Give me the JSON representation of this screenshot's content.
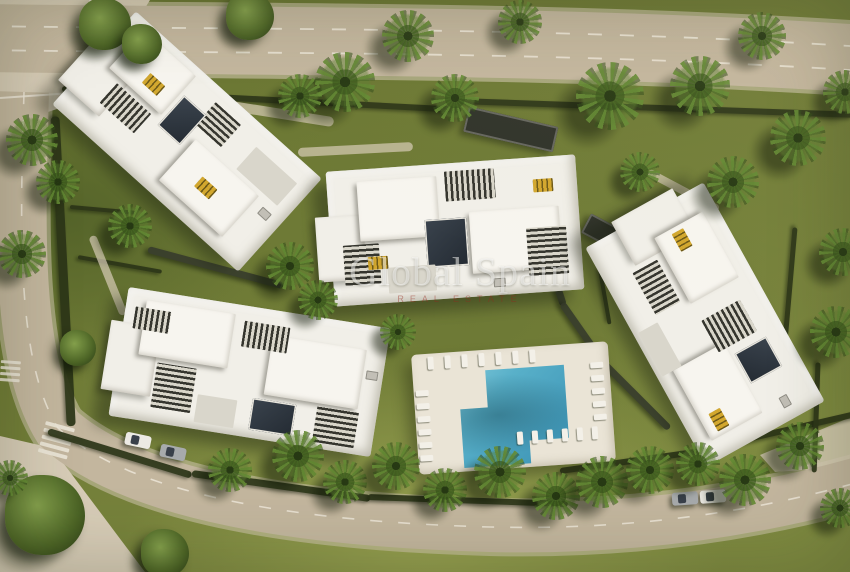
{
  "watermark": {
    "line1": "Global Spain",
    "line2": "REAL ESTATE"
  },
  "palette": {
    "building": "#f1efe8",
    "roof_shade": "#d9d6cb",
    "slat_dark": "#35352e",
    "road": "#c3b69e",
    "pavement": "#d7ccb7",
    "grass": "#6f7b36",
    "grass_light": "#8f9a4c",
    "grass_dark": "#55642a",
    "hedge": "#2c3518",
    "wall": "#383d2c",
    "pool_deck": "#eae4d6",
    "water_light": "#9fd8e4",
    "water_deep": "#2f86ac",
    "palm": "#5c8030",
    "lounger": "#d2a72e",
    "car_white": "#eceae4",
    "car_silver": "#a7aaac"
  },
  "scene": {
    "buildings": [
      {
        "id": "top-left",
        "x": 62,
        "y": 79,
        "w": 250,
        "h": 125,
        "rot": 42,
        "details": [
          {
            "t": "ext",
            "x": -12,
            "y": 28,
            "w": 55,
            "h": 75
          },
          {
            "t": "vol",
            "x": 18,
            "y": 8,
            "w": 70,
            "h": 52
          },
          {
            "t": "vol",
            "x": 130,
            "y": 55,
            "w": 85,
            "h": 55
          },
          {
            "t": "slat",
            "x": 34,
            "y": 66,
            "w": 46,
            "h": 26
          },
          {
            "t": "slatv",
            "x": 120,
            "y": 14,
            "w": 34,
            "h": 30
          },
          {
            "t": "glass",
            "x": 92,
            "y": 30,
            "w": 30,
            "h": 40
          },
          {
            "t": "terr",
            "x": 180,
            "y": 20,
            "w": 55,
            "h": 30
          },
          {
            "t": "yl",
            "x": 52,
            "y": 36,
            "w": 20,
            "h": 13
          },
          {
            "t": "yl",
            "x": 160,
            "y": 78,
            "w": 20,
            "h": 13
          },
          {
            "t": "ac",
            "x": 225,
            "y": 60,
            "w": 12,
            "h": 9
          }
        ]
      },
      {
        "id": "center",
        "x": 330,
        "y": 163,
        "w": 250,
        "h": 135,
        "rot": -4,
        "details": [
          {
            "t": "ext",
            "x": -14,
            "y": 45,
            "w": 48,
            "h": 65
          },
          {
            "t": "vol",
            "x": 30,
            "y": 12,
            "w": 80,
            "h": 60
          },
          {
            "t": "vol",
            "x": 140,
            "y": 50,
            "w": 90,
            "h": 62
          },
          {
            "t": "slatv",
            "x": 12,
            "y": 75,
            "w": 36,
            "h": 40
          },
          {
            "t": "slat",
            "x": 118,
            "y": 8,
            "w": 50,
            "h": 30
          },
          {
            "t": "glass",
            "x": 95,
            "y": 55,
            "w": 42,
            "h": 48
          },
          {
            "t": "slatv",
            "x": 196,
            "y": 70,
            "w": 40,
            "h": 48
          },
          {
            "t": "terr",
            "x": 55,
            "y": 100,
            "w": 48,
            "h": 26
          },
          {
            "t": "yl",
            "x": 36,
            "y": 88,
            "w": 20,
            "h": 13
          },
          {
            "t": "yl",
            "x": 206,
            "y": 22,
            "w": 20,
            "h": 13
          },
          {
            "t": "ac",
            "x": 160,
            "y": 118,
            "w": 12,
            "h": 9
          }
        ]
      },
      {
        "id": "right",
        "x": 580,
        "y": 257,
        "w": 250,
        "h": 135,
        "rot": 61,
        "details": [
          {
            "t": "ext",
            "x": -10,
            "y": 30,
            "w": 50,
            "h": 70
          },
          {
            "t": "vol",
            "x": 25,
            "y": 15,
            "w": 75,
            "h": 55
          },
          {
            "t": "vol",
            "x": 150,
            "y": 60,
            "w": 80,
            "h": 58
          },
          {
            "t": "slat",
            "x": 45,
            "y": 78,
            "w": 48,
            "h": 28
          },
          {
            "t": "slatv",
            "x": 120,
            "y": 25,
            "w": 36,
            "h": 44
          },
          {
            "t": "glass",
            "x": 165,
            "y": 20,
            "w": 34,
            "h": 36
          },
          {
            "t": "terr",
            "x": 100,
            "y": 108,
            "w": 50,
            "h": 22
          },
          {
            "t": "yl",
            "x": 30,
            "y": 40,
            "w": 20,
            "h": 13
          },
          {
            "t": "yl",
            "x": 205,
            "y": 95,
            "w": 20,
            "h": 13
          },
          {
            "t": "ac",
            "x": 225,
            "y": 30,
            "w": 12,
            "h": 9
          }
        ]
      },
      {
        "id": "bottom-left",
        "x": 117,
        "y": 307,
        "w": 265,
        "h": 130,
        "rot": 9,
        "details": [
          {
            "t": "ext",
            "x": -12,
            "y": 35,
            "w": 50,
            "h": 70
          },
          {
            "t": "vol",
            "x": 20,
            "y": 10,
            "w": 90,
            "h": 55
          },
          {
            "t": "vol",
            "x": 150,
            "y": 25,
            "w": 95,
            "h": 60
          },
          {
            "t": "slatv",
            "x": 40,
            "y": 70,
            "w": 40,
            "h": 45
          },
          {
            "t": "slat",
            "x": 120,
            "y": 15,
            "w": 46,
            "h": 26
          },
          {
            "t": "glass",
            "x": 140,
            "y": 90,
            "w": 44,
            "h": 32
          },
          {
            "t": "slatv",
            "x": 205,
            "y": 88,
            "w": 42,
            "h": 36
          },
          {
            "t": "terr",
            "x": 85,
            "y": 95,
            "w": 40,
            "h": 28
          },
          {
            "t": "slat",
            "x": 10,
            "y": 18,
            "w": 36,
            "h": 22
          },
          {
            "t": "ac",
            "x": 248,
            "y": 45,
            "w": 12,
            "h": 9
          }
        ]
      }
    ],
    "pool": {
      "x": 415,
      "y": 348,
      "w": 197,
      "h": 120,
      "rot": -4,
      "lounger_rows": [
        {
          "x": 16,
          "y": 3,
          "n": 7,
          "dx": 17,
          "dy": 0,
          "w": 6,
          "h": 13
        },
        {
          "x": 2,
          "y": 36,
          "n": 6,
          "dx": 0,
          "dy": 13,
          "w": 13,
          "h": 6
        },
        {
          "x": 178,
          "y": 20,
          "n": 5,
          "dx": 0,
          "dy": 13,
          "w": 13,
          "h": 6
        },
        {
          "x": 100,
          "y": 84,
          "n": 6,
          "dx": 15,
          "dy": 0,
          "w": 6,
          "h": 13
        }
      ]
    },
    "hedges": [
      {
        "x": 55,
        "y": 112,
        "len": 310,
        "w": 9,
        "rot": 87
      },
      {
        "x": 62,
        "y": 86,
        "len": 400,
        "w": 6,
        "rot": 3
      },
      {
        "x": 458,
        "y": 98,
        "len": 395,
        "w": 6,
        "rot": 2
      },
      {
        "x": 48,
        "y": 428,
        "len": 150,
        "w": 7,
        "rot": 17
      },
      {
        "x": 192,
        "y": 470,
        "len": 180,
        "w": 7,
        "rot": 8
      },
      {
        "x": 368,
        "y": 494,
        "len": 200,
        "w": 6,
        "rot": 2
      },
      {
        "x": 560,
        "y": 468,
        "len": 145,
        "w": 6,
        "rot": -8
      },
      {
        "x": 700,
        "y": 447,
        "len": 160,
        "w": 6,
        "rot": -13
      },
      {
        "x": 148,
        "y": 246,
        "len": 140,
        "w": 7,
        "rot": 15,
        "dark": true
      },
      {
        "x": 545,
        "y": 245,
        "len": 60,
        "w": 7,
        "rot": 72,
        "dark": true
      },
      {
        "x": 562,
        "y": 300,
        "len": 75,
        "w": 7,
        "rot": 55,
        "dark": true
      },
      {
        "x": 602,
        "y": 358,
        "len": 95,
        "w": 7,
        "rot": 45,
        "dark": true
      },
      {
        "x": 600,
        "y": 268,
        "len": 55,
        "w": 4,
        "rot": 80
      },
      {
        "x": 628,
        "y": 278,
        "len": 55,
        "w": 4,
        "rot": 80
      },
      {
        "x": 655,
        "y": 288,
        "len": 50,
        "w": 4,
        "rot": 80
      },
      {
        "x": 795,
        "y": 225,
        "len": 120,
        "w": 5,
        "rot": 95
      },
      {
        "x": 818,
        "y": 360,
        "len": 110,
        "w": 5,
        "rot": 92
      },
      {
        "x": 70,
        "y": 205,
        "len": 65,
        "w": 4,
        "rot": 5
      },
      {
        "x": 78,
        "y": 255,
        "len": 85,
        "w": 4,
        "rot": 10
      }
    ],
    "paths": [
      {
        "x": 225,
        "y": 100,
        "len": 110,
        "w": 10,
        "rot": 9
      },
      {
        "x": 298,
        "y": 148,
        "len": 115,
        "w": 9,
        "rot": -3
      },
      {
        "x": 92,
        "y": 232,
        "len": 85,
        "w": 8,
        "rot": 68
      },
      {
        "x": 648,
        "y": 168,
        "len": 80,
        "w": 8,
        "rot": 28
      }
    ],
    "ramps": [
      {
        "x": 466,
        "y": 106,
        "len": 92,
        "w": 26,
        "rot": 13
      },
      {
        "x": 586,
        "y": 212,
        "len": 70,
        "w": 22,
        "rot": 28
      }
    ],
    "palms": [
      [
        345,
        82,
        30
      ],
      [
        408,
        36,
        26
      ],
      [
        300,
        96,
        22
      ],
      [
        455,
        98,
        24
      ],
      [
        520,
        22,
        22
      ],
      [
        610,
        96,
        34
      ],
      [
        700,
        86,
        30
      ],
      [
        762,
        36,
        24
      ],
      [
        798,
        138,
        28
      ],
      [
        845,
        92,
        22
      ],
      [
        32,
        140,
        26
      ],
      [
        58,
        182,
        22
      ],
      [
        22,
        254,
        24
      ],
      [
        130,
        226,
        22
      ],
      [
        290,
        266,
        24
      ],
      [
        318,
        300,
        20
      ],
      [
        398,
        332,
        18
      ],
      [
        640,
        172,
        20
      ],
      [
        733,
        182,
        26
      ],
      [
        843,
        252,
        24
      ],
      [
        836,
        332,
        26
      ],
      [
        230,
        470,
        22
      ],
      [
        298,
        456,
        26
      ],
      [
        345,
        482,
        22
      ],
      [
        396,
        466,
        24
      ],
      [
        445,
        490,
        22
      ],
      [
        500,
        472,
        26
      ],
      [
        556,
        496,
        24
      ],
      [
        602,
        482,
        26
      ],
      [
        650,
        470,
        24
      ],
      [
        698,
        464,
        22
      ],
      [
        745,
        480,
        26
      ],
      [
        800,
        446,
        24
      ],
      [
        840,
        508,
        20
      ],
      [
        10,
        478,
        18
      ]
    ],
    "trees": [
      [
        105,
        24,
        26
      ],
      [
        142,
        44,
        20
      ],
      [
        250,
        16,
        24
      ],
      [
        45,
        515,
        40
      ],
      [
        165,
        553,
        24
      ],
      [
        78,
        348,
        18
      ]
    ],
    "cars": [
      {
        "x": 125,
        "y": 434,
        "rot": 12,
        "c": "car_white"
      },
      {
        "x": 160,
        "y": 446,
        "rot": 12,
        "c": "car_silver"
      },
      {
        "x": 700,
        "y": 490,
        "rot": -4,
        "c": "car_white"
      },
      {
        "x": 672,
        "y": 492,
        "rot": -4,
        "c": "car_silver"
      }
    ]
  }
}
